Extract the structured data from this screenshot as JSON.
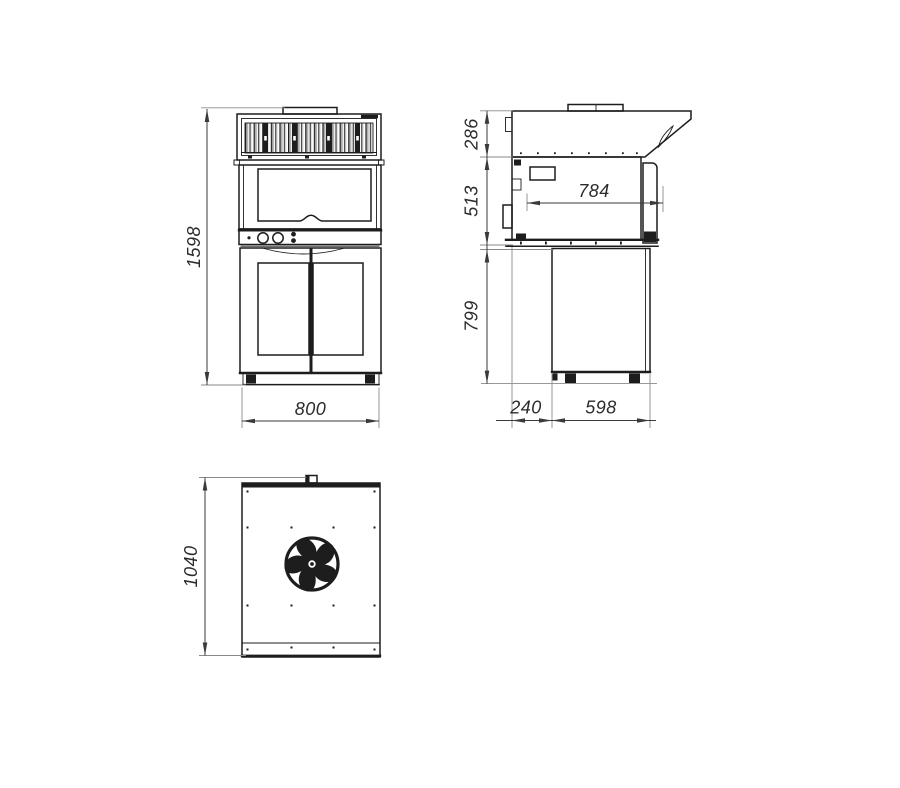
{
  "drawing": {
    "front_view": {
      "overall_height": "1598",
      "overall_width": "800"
    },
    "side_view": {
      "hood_height": "286",
      "body_height": "513",
      "stand_height": "799",
      "body_depth": "784",
      "stand_offset": "240",
      "stand_depth": "598"
    },
    "rear_view": {
      "overall_height": "1040"
    }
  },
  "colors": {
    "line": "#1d1d1d",
    "dimension": "#3a3a3a",
    "extension": "#8a8a8a",
    "shade": "#b0b0b0",
    "background": "#ffffff"
  }
}
